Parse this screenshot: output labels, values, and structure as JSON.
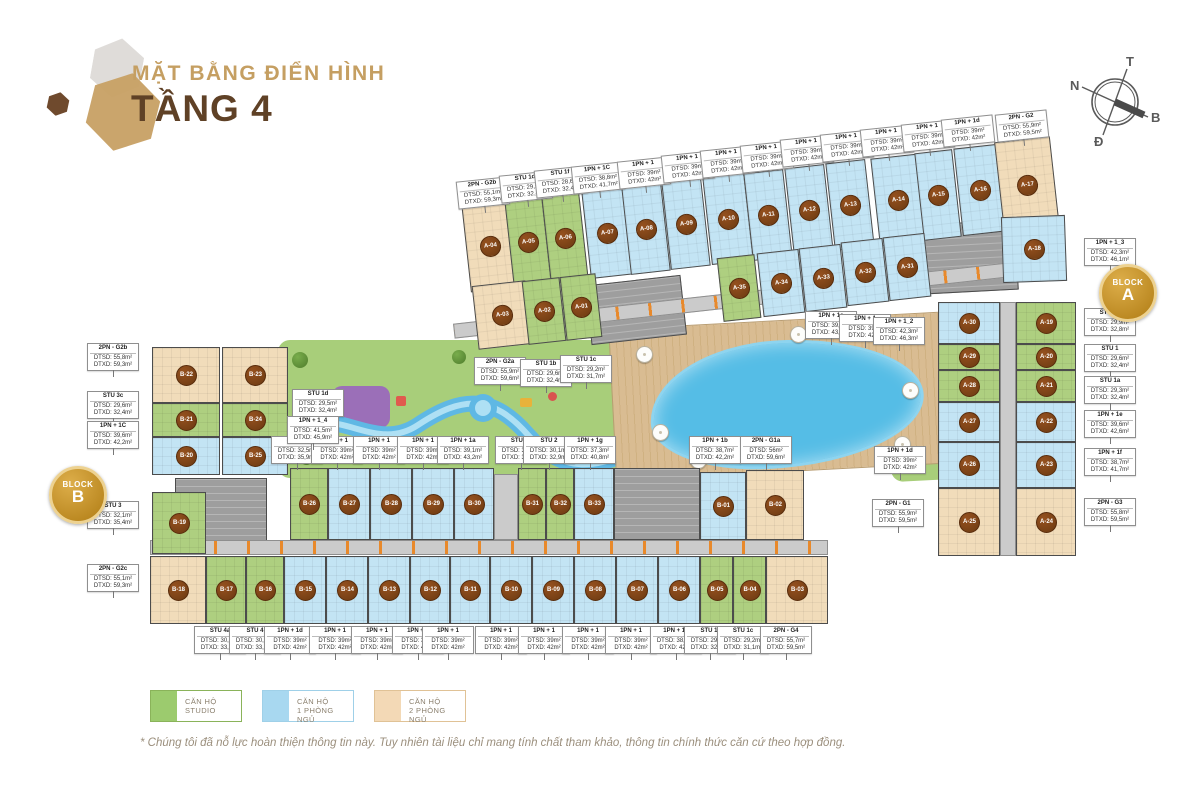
{
  "header": {
    "subtitle": "MẶT BẰNG ĐIỂN HÌNH",
    "title": "TẦNG 4"
  },
  "compass": {
    "top": "T",
    "left": "N",
    "right": "B",
    "bottom": "Đ"
  },
  "badges": {
    "a": {
      "word": "BLOCK",
      "letter": "A"
    },
    "b": {
      "word": "BLOCK",
      "letter": "B"
    }
  },
  "legend": [
    {
      "line1": "CĂN HỘ",
      "line2": "STUDIO",
      "type": "studio"
    },
    {
      "line1": "CĂN HỘ",
      "line2": "1 PHÒNG NGỦ",
      "type": "one"
    },
    {
      "line1": "CĂN HỘ",
      "line2": "2 PHÒNG NGỦ",
      "type": "two"
    }
  ],
  "colors": {
    "studio": "#aecf80",
    "one_bedroom": "#c3e4f4",
    "two_bedroom": "#f1dcba",
    "marker": "#6b3a12",
    "gold": "#c39432",
    "title_tan": "#c59f62",
    "title_brown": "#5f4126"
  },
  "footnote": "* Chúng tôi đã nỗ lực hoàn thiện thông tin này. Tuy nhiên tài liệu chỉ mang tính chất tham khảo, thông tin chính thức căn cứ theo hợp đồng.",
  "units": [
    {
      "id": "A-04",
      "t": "two",
      "x": 466,
      "y": 202,
      "w": 48,
      "h": 88,
      "r": -6.3
    },
    {
      "id": "A-05",
      "t": "studio",
      "x": 509,
      "y": 198,
      "w": 38,
      "h": 88,
      "r": -6.3
    },
    {
      "id": "A-06",
      "t": "studio",
      "x": 546,
      "y": 194,
      "w": 38,
      "h": 88,
      "r": -6.3
    },
    {
      "id": "A-07",
      "t": "one",
      "x": 586,
      "y": 189,
      "w": 42,
      "h": 88,
      "r": -6.3
    },
    {
      "id": "A-08",
      "t": "one",
      "x": 626,
      "y": 185,
      "w": 40,
      "h": 88,
      "r": -6.3
    },
    {
      "id": "A-09",
      "t": "one",
      "x": 666,
      "y": 180,
      "w": 40,
      "h": 88,
      "r": -6.3
    },
    {
      "id": "A-10",
      "t": "one",
      "x": 707,
      "y": 175,
      "w": 42,
      "h": 88,
      "r": -6.3
    },
    {
      "id": "A-11",
      "t": "one",
      "x": 748,
      "y": 171,
      "w": 40,
      "h": 88,
      "r": -6.3
    },
    {
      "id": "A-12",
      "t": "one",
      "x": 789,
      "y": 166,
      "w": 40,
      "h": 88,
      "r": -6.3
    },
    {
      "id": "A-13",
      "t": "one",
      "x": 830,
      "y": 161,
      "w": 40,
      "h": 88,
      "r": -6.3
    },
    {
      "id": "A-14",
      "t": "one",
      "x": 875,
      "y": 156,
      "w": 46,
      "h": 88,
      "r": -6.3
    },
    {
      "id": "A-15",
      "t": "one",
      "x": 919,
      "y": 151,
      "w": 38,
      "h": 88,
      "r": -6.3
    },
    {
      "id": "A-16",
      "t": "one",
      "x": 958,
      "y": 146,
      "w": 44,
      "h": 88,
      "r": -6.3
    },
    {
      "id": "A-17",
      "t": "two",
      "x": 999,
      "y": 139,
      "w": 56,
      "h": 92,
      "r": -6.3
    },
    {
      "id": "A-03",
      "t": "two",
      "x": 475,
      "y": 283,
      "w": 54,
      "h": 64,
      "r": -6.3
    },
    {
      "id": "A-02",
      "t": "studio",
      "x": 525,
      "y": 279,
      "w": 38,
      "h": 64,
      "r": -6.3
    },
    {
      "id": "A-01",
      "t": "studio",
      "x": 563,
      "y": 275,
      "w": 36,
      "h": 64,
      "r": -6.3
    },
    {
      "id": "A-35",
      "t": "studio",
      "x": 720,
      "y": 256,
      "w": 38,
      "h": 64,
      "r": -6.3
    },
    {
      "id": "A-34",
      "t": "one",
      "x": 760,
      "y": 251,
      "w": 42,
      "h": 64,
      "r": -6.3
    },
    {
      "id": "A-33",
      "t": "one",
      "x": 802,
      "y": 246,
      "w": 42,
      "h": 64,
      "r": -6.3
    },
    {
      "id": "A-32",
      "t": "one",
      "x": 844,
      "y": 240,
      "w": 42,
      "h": 64,
      "r": -6.3
    },
    {
      "id": "A-31",
      "t": "one",
      "x": 886,
      "y": 235,
      "w": 42,
      "h": 64,
      "r": -6.3
    },
    {
      "id": "A-18",
      "t": "one",
      "x": 1002,
      "y": 216,
      "w": 64,
      "h": 66,
      "r": -2
    },
    {
      "id": "A-30",
      "t": "one",
      "x": 938,
      "y": 302,
      "w": 62,
      "h": 42,
      "r": 0
    },
    {
      "id": "A-29",
      "t": "studio",
      "x": 938,
      "y": 344,
      "w": 62,
      "h": 26,
      "r": 0
    },
    {
      "id": "A-28",
      "t": "studio",
      "x": 938,
      "y": 370,
      "w": 62,
      "h": 32,
      "r": 0
    },
    {
      "id": "A-27",
      "t": "one",
      "x": 938,
      "y": 402,
      "w": 62,
      "h": 40,
      "r": 0
    },
    {
      "id": "A-26",
      "t": "one",
      "x": 938,
      "y": 442,
      "w": 62,
      "h": 46,
      "r": 0
    },
    {
      "id": "A-25",
      "t": "two",
      "x": 938,
      "y": 488,
      "w": 62,
      "h": 68,
      "r": 0
    },
    {
      "id": "A-19",
      "t": "studio",
      "x": 1016,
      "y": 302,
      "w": 60,
      "h": 42,
      "r": 0
    },
    {
      "id": "A-20",
      "t": "studio",
      "x": 1016,
      "y": 344,
      "w": 60,
      "h": 26,
      "r": 0
    },
    {
      "id": "A-21",
      "t": "studio",
      "x": 1016,
      "y": 370,
      "w": 60,
      "h": 32,
      "r": 0
    },
    {
      "id": "A-22",
      "t": "one",
      "x": 1016,
      "y": 402,
      "w": 60,
      "h": 40,
      "r": 0
    },
    {
      "id": "A-23",
      "t": "one",
      "x": 1016,
      "y": 442,
      "w": 60,
      "h": 46,
      "r": 0
    },
    {
      "id": "A-24",
      "t": "two",
      "x": 1016,
      "y": 488,
      "w": 60,
      "h": 68,
      "r": 0
    },
    {
      "id": "B-22",
      "t": "two",
      "x": 152,
      "y": 347,
      "w": 68,
      "h": 56,
      "r": 0
    },
    {
      "id": "B-23",
      "t": "two",
      "x": 222,
      "y": 347,
      "w": 66,
      "h": 56,
      "r": 0
    },
    {
      "id": "B-21",
      "t": "studio",
      "x": 152,
      "y": 403,
      "w": 68,
      "h": 34,
      "r": 0
    },
    {
      "id": "B-24",
      "t": "studio",
      "x": 222,
      "y": 403,
      "w": 66,
      "h": 34,
      "r": 0
    },
    {
      "id": "B-20",
      "t": "one",
      "x": 152,
      "y": 437,
      "w": 68,
      "h": 38,
      "r": 0
    },
    {
      "id": "B-25",
      "t": "one",
      "x": 222,
      "y": 437,
      "w": 66,
      "h": 38,
      "r": 0
    },
    {
      "id": "B-19",
      "t": "studio",
      "x": 152,
      "y": 492,
      "w": 54,
      "h": 62,
      "r": 0
    },
    {
      "id": "B-26",
      "t": "studio",
      "x": 290,
      "y": 468,
      "w": 38,
      "h": 72,
      "r": 0
    },
    {
      "id": "B-27",
      "t": "one",
      "x": 328,
      "y": 468,
      "w": 42,
      "h": 72,
      "r": 0
    },
    {
      "id": "B-28",
      "t": "one",
      "x": 370,
      "y": 468,
      "w": 42,
      "h": 72,
      "r": 0
    },
    {
      "id": "B-29",
      "t": "one",
      "x": 412,
      "y": 468,
      "w": 42,
      "h": 72,
      "r": 0
    },
    {
      "id": "B-30",
      "t": "one",
      "x": 454,
      "y": 468,
      "w": 40,
      "h": 72,
      "r": 0
    },
    {
      "id": "B-31",
      "t": "studio",
      "x": 518,
      "y": 468,
      "w": 28,
      "h": 72,
      "r": 0
    },
    {
      "id": "B-32",
      "t": "studio",
      "x": 546,
      "y": 468,
      "w": 28,
      "h": 72,
      "r": 0
    },
    {
      "id": "B-33",
      "t": "one",
      "x": 574,
      "y": 468,
      "w": 40,
      "h": 72,
      "r": 0
    },
    {
      "id": "B-01",
      "t": "one",
      "x": 700,
      "y": 472,
      "w": 46,
      "h": 68,
      "r": 0
    },
    {
      "id": "B-02",
      "t": "two",
      "x": 746,
      "y": 470,
      "w": 58,
      "h": 70,
      "r": 0
    },
    {
      "id": "B-18",
      "t": "two",
      "x": 150,
      "y": 556,
      "w": 56,
      "h": 68,
      "r": 0
    },
    {
      "id": "B-17",
      "t": "studio",
      "x": 206,
      "y": 556,
      "w": 40,
      "h": 68,
      "r": 0
    },
    {
      "id": "B-16",
      "t": "studio",
      "x": 246,
      "y": 556,
      "w": 38,
      "h": 68,
      "r": 0
    },
    {
      "id": "B-15",
      "t": "one",
      "x": 284,
      "y": 556,
      "w": 42,
      "h": 68,
      "r": 0
    },
    {
      "id": "B-14",
      "t": "one",
      "x": 326,
      "y": 556,
      "w": 42,
      "h": 68,
      "r": 0
    },
    {
      "id": "B-13",
      "t": "one",
      "x": 368,
      "y": 556,
      "w": 42,
      "h": 68,
      "r": 0
    },
    {
      "id": "B-12",
      "t": "one",
      "x": 410,
      "y": 556,
      "w": 40,
      "h": 68,
      "r": 0
    },
    {
      "id": "B-11",
      "t": "one",
      "x": 450,
      "y": 556,
      "w": 40,
      "h": 68,
      "r": 0
    },
    {
      "id": "B-10",
      "t": "one",
      "x": 490,
      "y": 556,
      "w": 42,
      "h": 68,
      "r": 0
    },
    {
      "id": "B-09",
      "t": "one",
      "x": 532,
      "y": 556,
      "w": 42,
      "h": 68,
      "r": 0
    },
    {
      "id": "B-08",
      "t": "one",
      "x": 574,
      "y": 556,
      "w": 42,
      "h": 68,
      "r": 0
    },
    {
      "id": "B-07",
      "t": "one",
      "x": 616,
      "y": 556,
      "w": 42,
      "h": 68,
      "r": 0
    },
    {
      "id": "B-06",
      "t": "one",
      "x": 658,
      "y": 556,
      "w": 42,
      "h": 68,
      "r": 0
    },
    {
      "id": "B-05",
      "t": "studio",
      "x": 700,
      "y": 556,
      "w": 33,
      "h": 68,
      "r": 0
    },
    {
      "id": "B-04",
      "t": "studio",
      "x": 733,
      "y": 556,
      "w": 33,
      "h": 68,
      "r": 0
    },
    {
      "id": "B-03",
      "t": "two",
      "x": 766,
      "y": 556,
      "w": 62,
      "h": 68,
      "r": 0
    }
  ],
  "cores": [
    {
      "k": "core",
      "x": 588,
      "y": 280,
      "w": 96,
      "h": 60,
      "r": -6.3
    },
    {
      "k": "core",
      "x": 925,
      "y": 222,
      "w": 92,
      "h": 70,
      "r": -3
    },
    {
      "k": "core",
      "x": 614,
      "y": 468,
      "w": 86,
      "h": 72,
      "r": 0
    },
    {
      "k": "core",
      "x": 175,
      "y": 478,
      "w": 92,
      "h": 76,
      "r": 0
    },
    {
      "k": "corr",
      "x": 452,
      "y": 290,
      "w": 614,
      "h": 15,
      "r": -6.3
    },
    {
      "k": "corr",
      "x": 150,
      "y": 540,
      "w": 678,
      "h": 15,
      "r": 0
    },
    {
      "k": "corr",
      "x": 1000,
      "y": 302,
      "w": 16,
      "h": 254,
      "r": 0
    },
    {
      "k": "corr",
      "x": 494,
      "y": 474,
      "w": 24,
      "h": 66,
      "r": 0
    }
  ],
  "callouts": [
    {
      "t": "2PN - G2b",
      "a": "DTSD: 55,1m²",
      "b": "DTXD: 59,3m²",
      "x": 483,
      "y": 193,
      "r": -6
    },
    {
      "t": "STU 1d",
      "a": "DTSD: 29,5m²",
      "b": "DTXD: 32,4m²",
      "x": 526,
      "y": 187,
      "r": -6
    },
    {
      "t": "STU 1f",
      "a": "DTSD: 28,6m²",
      "b": "DTXD: 32,4m²",
      "x": 561,
      "y": 182,
      "r": -6
    },
    {
      "t": "1PN + 1C",
      "a": "DTSD: 38,8m²",
      "b": "DTXD: 41,7m²",
      "x": 598,
      "y": 178,
      "r": -6
    },
    {
      "t": "1PN + 1",
      "a": "DTSD: 39m²",
      "b": "DTXD: 42m²",
      "x": 644,
      "y": 173,
      "r": -6
    },
    {
      "t": "1PN + 1",
      "a": "DTSD: 39m²",
      "b": "DTXD: 42m²",
      "x": 688,
      "y": 167,
      "r": -6
    },
    {
      "t": "1PN + 1",
      "a": "DTSD: 39m²",
      "b": "DTXD: 42m²",
      "x": 727,
      "y": 162,
      "r": -6
    },
    {
      "t": "1PN + 1",
      "a": "DTSD: 39m²",
      "b": "DTXD: 42m²",
      "x": 767,
      "y": 157,
      "r": -6
    },
    {
      "t": "1PN + 1",
      "a": "DTSD: 39m²",
      "b": "DTXD: 42m²",
      "x": 807,
      "y": 151,
      "r": -6
    },
    {
      "t": "1PN + 1",
      "a": "DTSD: 39m²",
      "b": "DTXD: 42m²",
      "x": 847,
      "y": 146,
      "r": -6
    },
    {
      "t": "1PN + 1",
      "a": "DTSD: 39m²",
      "b": "DTXD: 42m²",
      "x": 887,
      "y": 141,
      "r": -6
    },
    {
      "t": "1PN + 1",
      "a": "DTSD: 39m²",
      "b": "DTXD: 42m²",
      "x": 928,
      "y": 136,
      "r": -6
    },
    {
      "t": "1PN + 1d",
      "a": "DTSD: 39m²",
      "b": "DTXD: 42m²",
      "x": 968,
      "y": 131,
      "r": -6
    },
    {
      "t": "2PN - G2",
      "a": "DTSD: 55,9m²",
      "b": "DTXD: 59,5m²",
      "x": 1022,
      "y": 126,
      "r": -6
    },
    {
      "t": "1PN + 1_3",
      "a": "DTSD: 42,3m²",
      "b": "DTXD: 46,1m²",
      "x": 1110,
      "y": 252,
      "r": 0
    },
    {
      "t": "STU 1g",
      "a": "DTSD: 29,9m²",
      "b": "DTXD: 32,8m²",
      "x": 1110,
      "y": 322,
      "r": 0
    },
    {
      "t": "STU 1",
      "a": "DTSD: 29,6m²",
      "b": "DTXD: 32,4m²",
      "x": 1110,
      "y": 358,
      "r": 0
    },
    {
      "t": "STU 1a",
      "a": "DTSD: 29,3m²",
      "b": "DTXD: 32,4m²",
      "x": 1110,
      "y": 390,
      "r": 0
    },
    {
      "t": "1PN + 1e",
      "a": "DTSD: 39,6m²",
      "b": "DTXD: 42,6m²",
      "x": 1110,
      "y": 424,
      "r": 0
    },
    {
      "t": "1PN + 1f",
      "a": "DTSD: 38,7m²",
      "b": "DTXD: 41,7m²",
      "x": 1110,
      "y": 462,
      "r": 0
    },
    {
      "t": "2PN - G3",
      "a": "DTSD: 55,8m²",
      "b": "DTXD: 59,5m²",
      "x": 1110,
      "y": 512,
      "r": 0
    },
    {
      "t": "2PN - G2b",
      "a": "DTSD: 55,8m²",
      "b": "DTXD: 59,3m²",
      "x": 113,
      "y": 357,
      "r": 0
    },
    {
      "t": "STU 3c",
      "a": "DTSD: 29,6m²",
      "b": "DTXD: 32,4m²",
      "x": 113,
      "y": 405,
      "r": 0
    },
    {
      "t": "1PN + 1C",
      "a": "DTSD: 39,6m²",
      "b": "DTXD: 42,2m²",
      "x": 113,
      "y": 435,
      "r": 0
    },
    {
      "t": "STU 3",
      "a": "DTSD: 32,1m²",
      "b": "DTXD: 35,4m²",
      "x": 113,
      "y": 515,
      "r": 0
    },
    {
      "t": "2PN - G2c",
      "a": "DTSD: 55,1m²",
      "b": "DTXD: 59,3m²",
      "x": 113,
      "y": 578,
      "r": 0
    },
    {
      "t": "STU 4a",
      "a": "DTSD: 30,3m²",
      "b": "DTXD: 33,2m²",
      "x": 220,
      "y": 640,
      "r": 0
    },
    {
      "t": "STU 4",
      "a": "DTSD: 30,4m²",
      "b": "DTXD: 33,2m²",
      "x": 255,
      "y": 640,
      "r": 0
    },
    {
      "t": "1PN + 1d",
      "a": "DTSD: 39m²",
      "b": "DTXD: 42m²",
      "x": 290,
      "y": 640,
      "r": 0
    },
    {
      "t": "1PN + 1",
      "a": "DTSD: 39m²",
      "b": "DTXD: 42m²",
      "x": 335,
      "y": 640,
      "r": 0
    },
    {
      "t": "1PN + 1",
      "a": "DTSD: 39m²",
      "b": "DTXD: 42m²",
      "x": 377,
      "y": 640,
      "r": 0
    },
    {
      "t": "1PN + 1",
      "a": "DTSD: 39m²",
      "b": "DTXD: 42m²",
      "x": 418,
      "y": 640,
      "r": 0
    },
    {
      "t": "1PN + 1",
      "a": "DTSD: 39m²",
      "b": "DTXD: 42m²",
      "x": 448,
      "y": 640,
      "r": 0
    },
    {
      "t": "1PN + 1",
      "a": "DTSD: 39m²",
      "b": "DTXD: 42m²",
      "x": 501,
      "y": 640,
      "r": 0
    },
    {
      "t": "1PN + 1",
      "a": "DTSD: 39m²",
      "b": "DTXD: 42m²",
      "x": 544,
      "y": 640,
      "r": 0
    },
    {
      "t": "1PN + 1",
      "a": "DTSD: 39m²",
      "b": "DTXD: 42m²",
      "x": 588,
      "y": 640,
      "r": 0
    },
    {
      "t": "1PN + 1",
      "a": "DTSD: 39m²",
      "b": "DTXD: 42m²",
      "x": 631,
      "y": 640,
      "r": 0
    },
    {
      "t": "1PN + 1d",
      "a": "DTSD: 38,9m²",
      "b": "DTXD: 42m²",
      "x": 676,
      "y": 640,
      "r": 0
    },
    {
      "t": "STU 1f",
      "a": "DTSD: 29,6m²",
      "b": "DTXD: 32,4m²",
      "x": 710,
      "y": 640,
      "r": 0
    },
    {
      "t": "STU 1c",
      "a": "DTSD: 29,2m²",
      "b": "DTXD: 31,1m²",
      "x": 743,
      "y": 640,
      "r": 0
    },
    {
      "t": "2PN - G4",
      "a": "DTSD: 55,7m²",
      "b": "DTXD: 59,5m²",
      "x": 786,
      "y": 640,
      "r": 0
    },
    {
      "t": "STU 2b",
      "a": "DTSD: 32,5m²",
      "b": "DTXD: 35,9m²",
      "x": 297,
      "y": 450,
      "r": 0
    },
    {
      "t": "1PN + 1",
      "a": "DTSD: 39m²",
      "b": "DTXD: 42m²",
      "x": 337,
      "y": 450,
      "r": 0
    },
    {
      "t": "1PN + 1",
      "a": "DTSD: 39m²",
      "b": "DTXD: 42m²",
      "x": 379,
      "y": 450,
      "r": 0
    },
    {
      "t": "1PN + 1",
      "a": "DTSD: 39m²",
      "b": "DTXD: 42m²",
      "x": 423,
      "y": 450,
      "r": 0
    },
    {
      "t": "1PN + 1a",
      "a": "DTSD: 39,1m²",
      "b": "DTXD: 43,2m²",
      "x": 463,
      "y": 450,
      "r": 0
    },
    {
      "t": "STU 2a",
      "a": "DTSD: 30,2m²",
      "b": "DTXD: 33,1m²",
      "x": 521,
      "y": 450,
      "r": 0
    },
    {
      "t": "STU 2",
      "a": "DTSD: 30,1m²",
      "b": "DTXD: 32,9m²",
      "x": 549,
      "y": 450,
      "r": 0
    },
    {
      "t": "1PN + 1g",
      "a": "DTSD: 37,3m²",
      "b": "DTXD: 40,8m²",
      "x": 590,
      "y": 450,
      "r": 0
    },
    {
      "t": "1PN + 1b",
      "a": "DTSD: 38,7m²",
      "b": "DTXD: 42,2m²",
      "x": 715,
      "y": 450,
      "r": 0
    },
    {
      "t": "2PN - G1a",
      "a": "DTSD: 56m²",
      "b": "DTXD: 59,6m²",
      "x": 766,
      "y": 450,
      "r": 0
    },
    {
      "t": "1PN + 1d",
      "a": "DTSD: 39m²",
      "b": "DTXD: 42m²",
      "x": 900,
      "y": 460,
      "r": 0
    },
    {
      "t": "2PN - G1",
      "a": "DTSD: 55,9m²",
      "b": "DTXD: 59,5m²",
      "x": 898,
      "y": 513,
      "r": 0
    },
    {
      "t": "2PN - G2a",
      "a": "DTSD: 55,9m²",
      "b": "DTXD: 59,6m²",
      "x": 500,
      "y": 371,
      "r": 0
    },
    {
      "t": "STU 1b",
      "a": "DTSD: 29,6m²",
      "b": "DTXD: 32,4m²",
      "x": 546,
      "y": 373,
      "r": 0
    },
    {
      "t": "STU 1c",
      "a": "DTSD: 29,2m²",
      "b": "DTXD: 31,7m²",
      "x": 586,
      "y": 369,
      "r": 0
    },
    {
      "t": "STU 1d",
      "a": "DTSD: 29,5m²",
      "b": "DTXD: 32,4m²",
      "x": 318,
      "y": 403,
      "r": 0
    },
    {
      "t": "1PN + 1_4",
      "a": "DTSD: 41,5m²",
      "b": "DTXD: 45,9m²",
      "x": 313,
      "y": 430,
      "r": 0
    },
    {
      "t": "1PN + 1a",
      "a": "DTSD: 39,1m²",
      "b": "DTXD: 43,2m²",
      "x": 831,
      "y": 325,
      "r": 0
    },
    {
      "t": "1PN + 1",
      "a": "DTSD: 39m²",
      "b": "DTXD: 42m²",
      "x": 865,
      "y": 328,
      "r": 0
    },
    {
      "t": "1PN + 1_2",
      "a": "DTSD: 42,3m²",
      "b": "DTXD: 46,3m²",
      "x": 899,
      "y": 331,
      "r": 0
    }
  ]
}
